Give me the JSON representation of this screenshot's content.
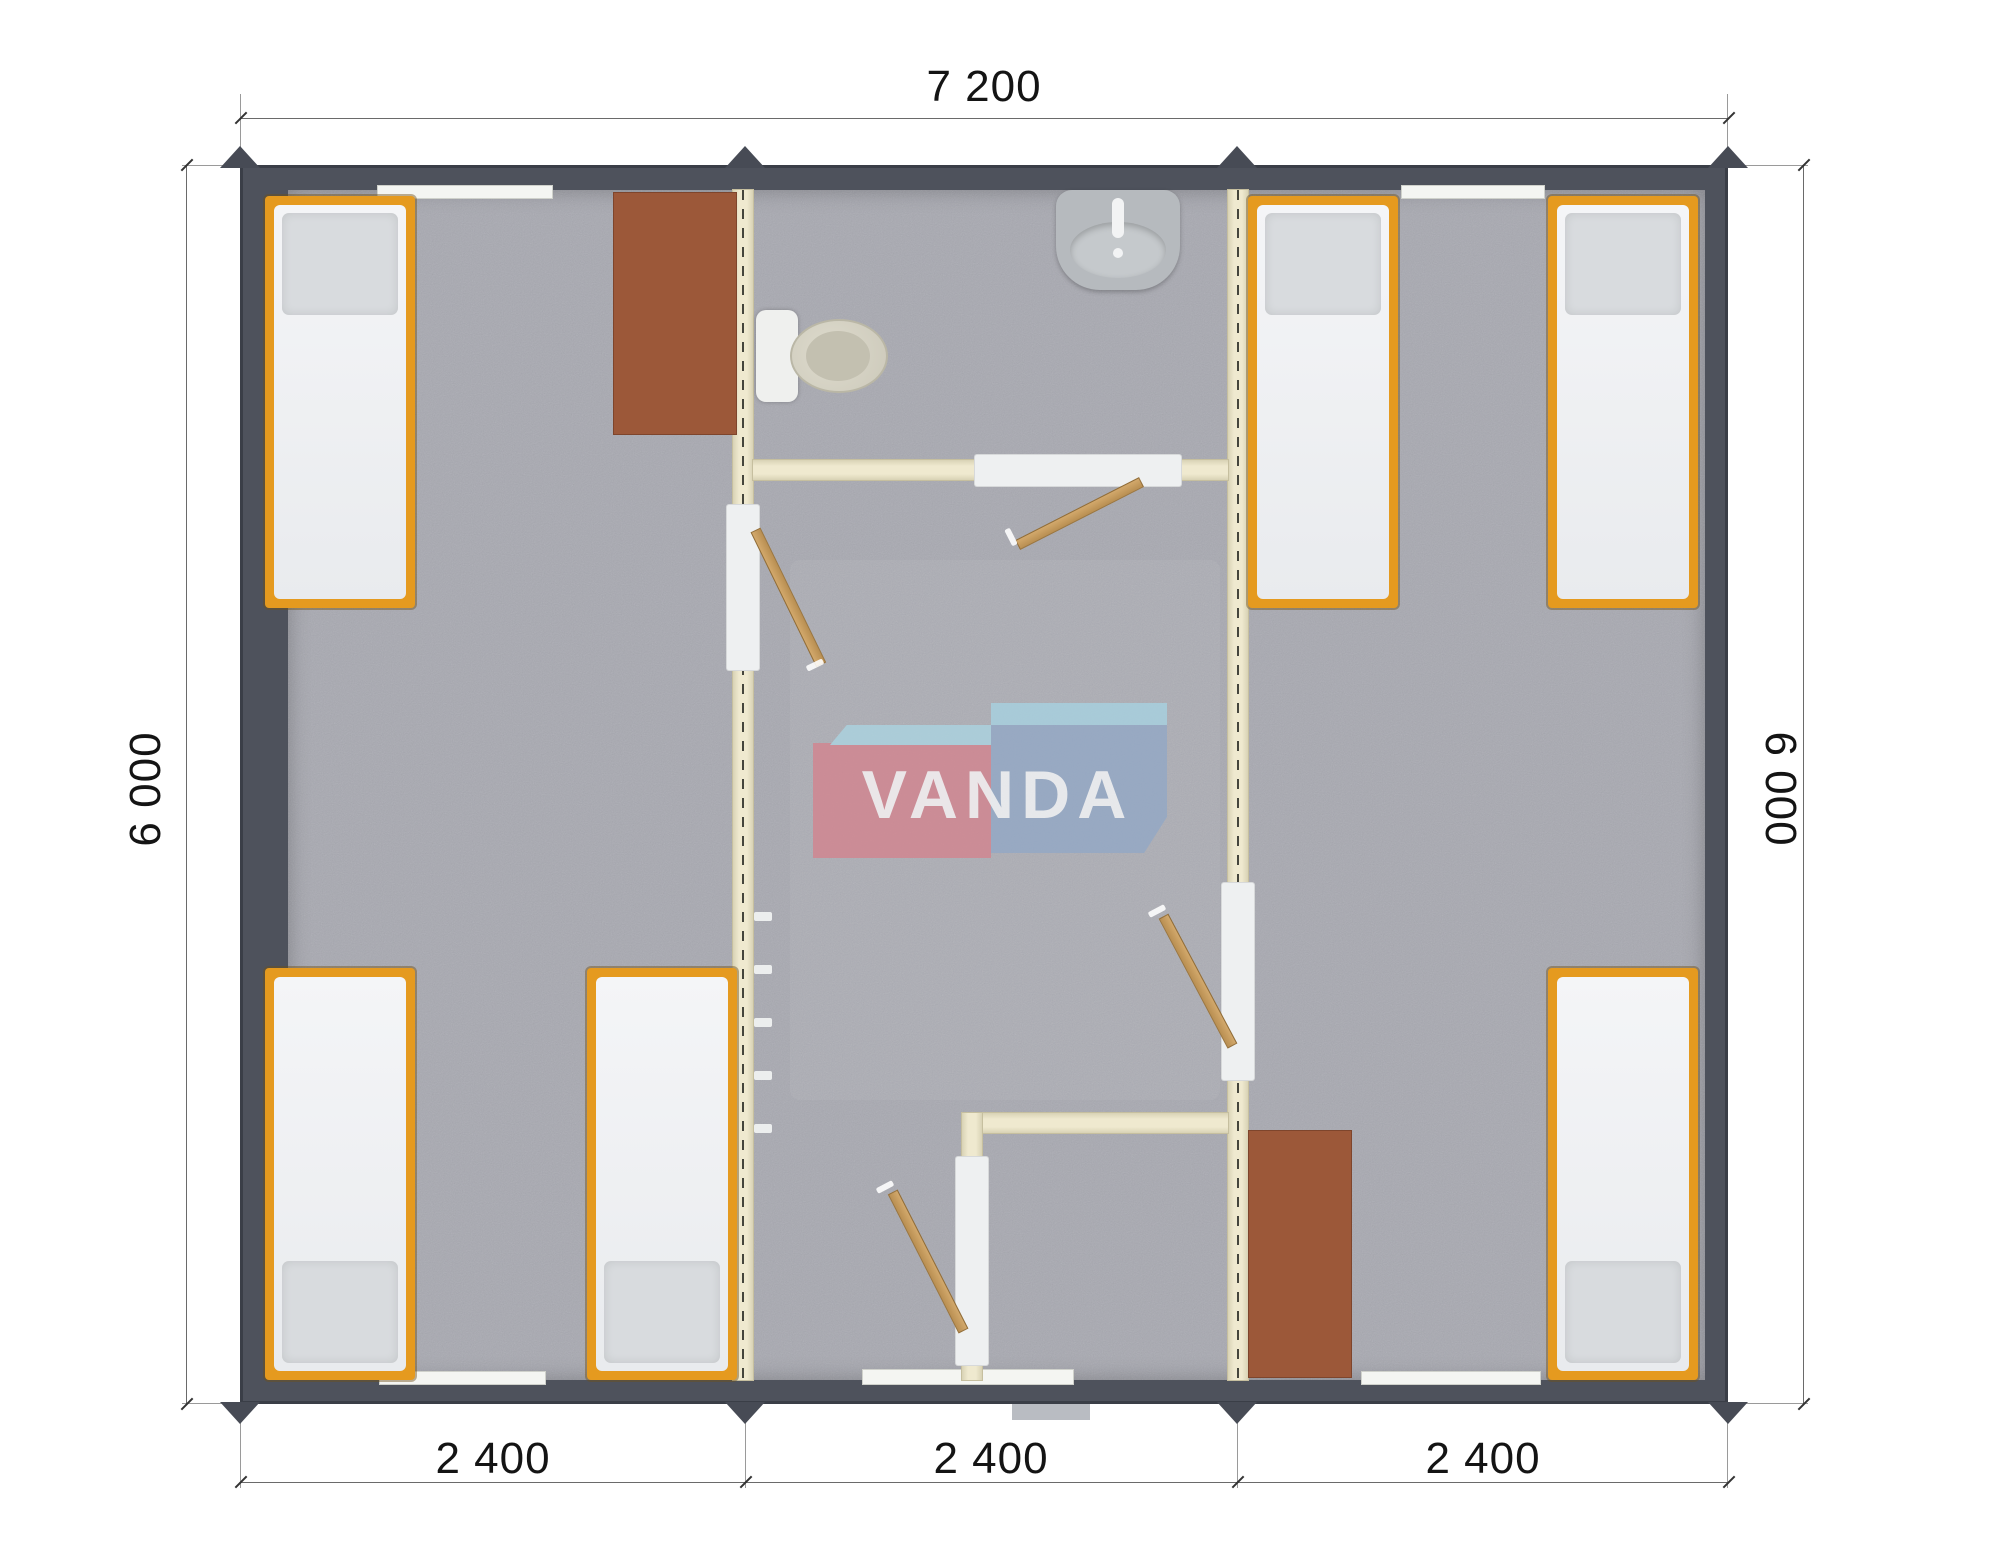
{
  "brand": {
    "logo_text": "VANDA"
  },
  "dimensions": {
    "top_width": "7 200",
    "left_height": "6 000",
    "right_height": "6 000",
    "bottom_segments": [
      "2 400",
      "2 400",
      "2 400"
    ]
  },
  "colors": {
    "exterior_wall": "#4e525c",
    "interior_wall_cream": "#efe9cf",
    "floor_gray": "#a8a9b1",
    "bed_frame_orange": "#e59a1f",
    "mattress_white": "#f4f5f7",
    "pillow_gray": "#d8dbde",
    "table_brown": "#9c5839",
    "door_wood": "#c9a163",
    "logo_red": "#d4838e",
    "logo_blue": "#92a8c6",
    "logo_light_blue": "#a7d3e2",
    "dimension_text": "#141414"
  },
  "fixtures": {
    "beds": 6,
    "tables": 2,
    "doors": 4,
    "toilet": 1,
    "sink": 1,
    "coat_hooks": 5,
    "module_joints": 2
  }
}
